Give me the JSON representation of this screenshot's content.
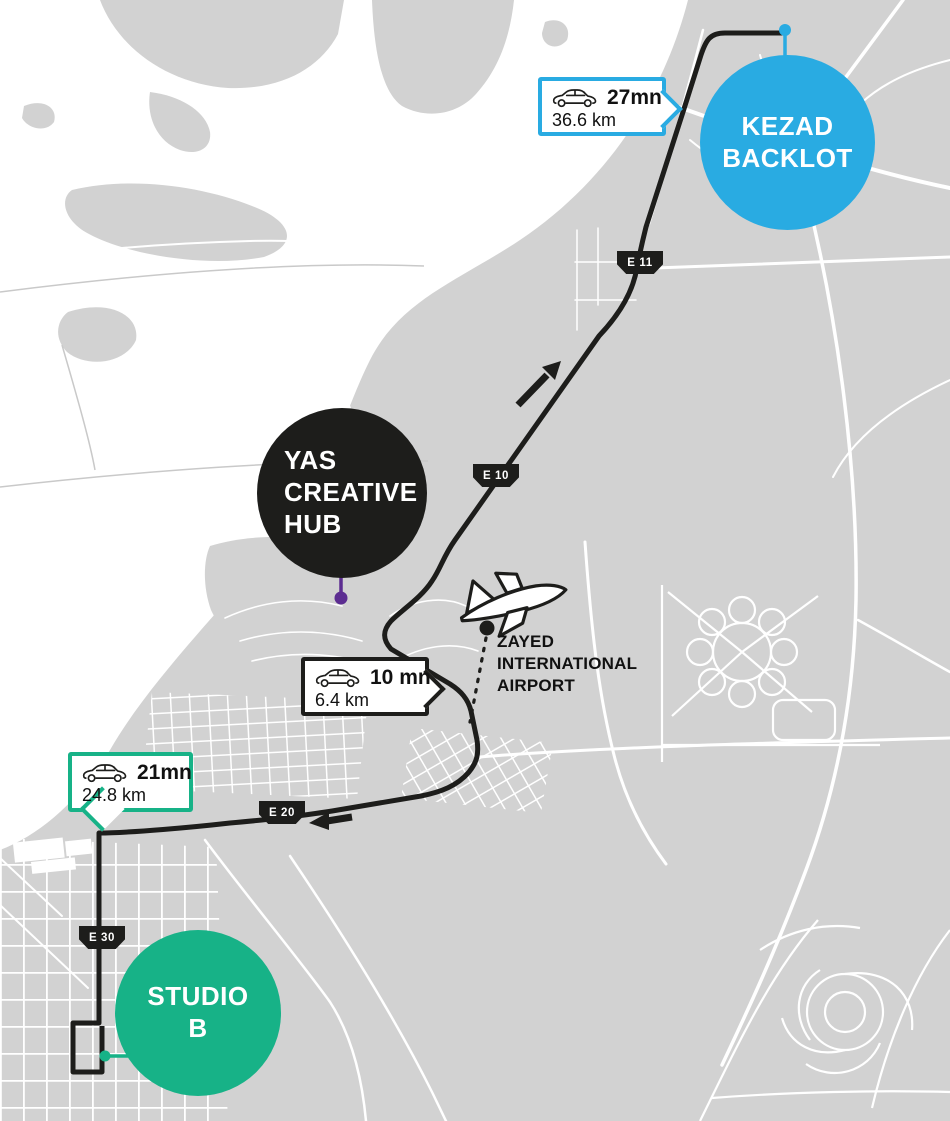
{
  "markers": {
    "kezad": {
      "line1": "KEZAD",
      "line2": "BACKLOT",
      "color": "#29abe2"
    },
    "yas": {
      "line1": "YAS",
      "line2": "CREATIVE",
      "line3": "HUB",
      "color": "#1d1d1b"
    },
    "studio_b": {
      "line1": "STUDIO",
      "line2": "B",
      "color": "#17b287"
    }
  },
  "airport": {
    "line1": "ZAYED",
    "line2": "INTERNATIONAL",
    "line3": "AIRPORT"
  },
  "route_badges": {
    "to_kezad": {
      "icon": "car-icon",
      "duration": "27mn",
      "distance": "36.6 km",
      "accent": "#29abe2"
    },
    "to_airport": {
      "icon": "car-icon",
      "duration": "10 mn",
      "distance": "6.4 km",
      "accent": "#1d1d1b"
    },
    "to_studio_b": {
      "icon": "car-icon",
      "duration": "21mn",
      "distance": "24.8 km",
      "accent": "#17b287"
    }
  },
  "road_labels": {
    "e11": "E 11",
    "e10": "E 10",
    "e20": "E 20",
    "e30": "E 30"
  },
  "colors": {
    "land": "#d2d2d2",
    "water": "#ffffff",
    "road": "#ffffff",
    "route": "#1d1d1b",
    "blue": "#29abe2",
    "green": "#17b287",
    "purple": "#5c2d91"
  }
}
